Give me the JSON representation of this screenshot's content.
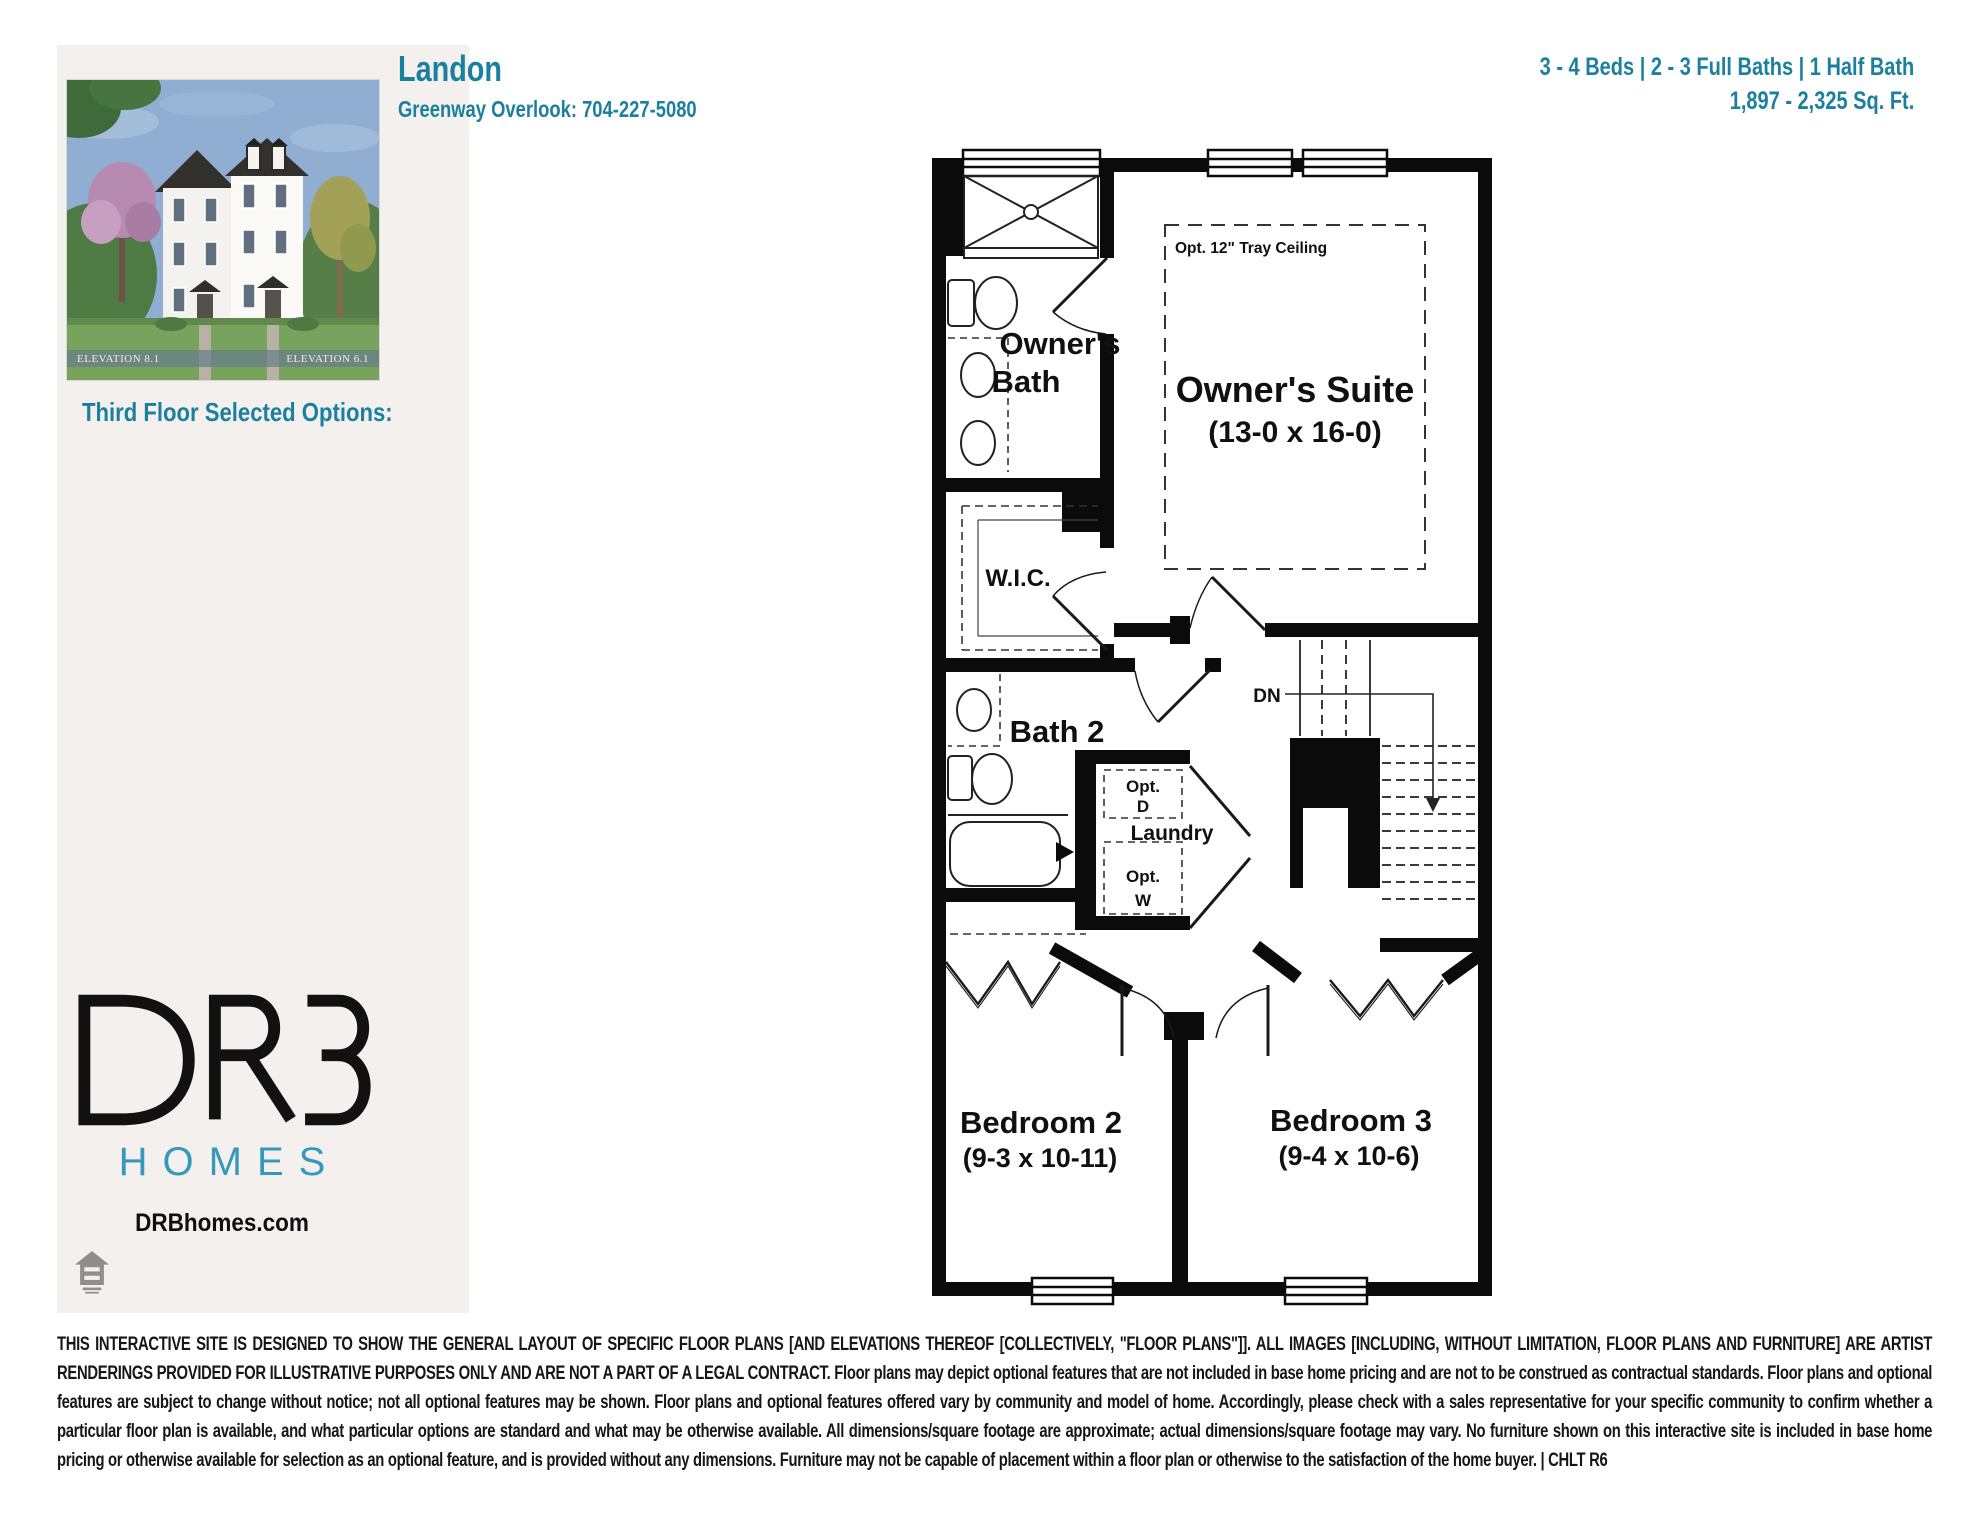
{
  "colors": {
    "teal": "#1b7f9f",
    "homes_blue": "#3598bd",
    "panel_bg": "#f3f0ee",
    "wall_black": "#0b0b0b"
  },
  "header": {
    "plan_name": "Landon",
    "community_phone": "Greenway Overlook: 704-227-5080",
    "specs_line1": "3 - 4 Beds | 2 - 3 Full Baths | 1 Half Bath",
    "specs_line2": "1,897 - 2,325 Sq. Ft."
  },
  "sidebar": {
    "elevation_left_label": "ELEVATION 8.1",
    "elevation_right_label": "ELEVATION 6.1",
    "selected_options_heading": "Third Floor Selected Options:",
    "logo": {
      "name": "DRB",
      "homes": "HOMES",
      "website": "DRBhomes.com"
    }
  },
  "floor_plan": {
    "rooms": {
      "owners_bath_line1": "Owner's",
      "owners_bath_line2": "Bath",
      "owners_suite_name": "Owner's Suite",
      "owners_suite_dims": "(13-0 x 16-0)",
      "tray_option": "Opt. 12\" Tray Ceiling",
      "wic": "W.I.C.",
      "bath2": "Bath 2",
      "dn": "DN",
      "opt_d_1": "Opt.",
      "opt_d_2": "D",
      "laundry": "Laundry",
      "opt_w_1": "Opt.",
      "opt_w_2": "W",
      "bedroom2_name": "Bedroom 2",
      "bedroom2_dims": "(9-3 x 10-11)",
      "bedroom3_name": "Bedroom 3",
      "bedroom3_dims": "(9-4 x 10-6)"
    }
  },
  "disclaimer": {
    "text": "THIS INTERACTIVE SITE IS DESIGNED TO SHOW THE GENERAL LAYOUT OF SPECIFIC FLOOR PLANS [AND ELEVATIONS THEREOF [COLLECTIVELY, \"FLOOR PLANS\"]]. ALL IMAGES [INCLUDING, WITHOUT LIMITATION, FLOOR PLANS AND FURNITURE] ARE ARTIST RENDERINGS PROVIDED FOR ILLUSTRATIVE PURPOSES ONLY AND ARE NOT A PART OF A LEGAL CONTRACT. Floor plans may depict optional features that are not included in base home pricing and are not to be construed as contractual standards. Floor plans and optional features are subject to change without notice; not all optional features may be shown. Floor plans and optional features offered vary by community and model of home. Accordingly, please check with a sales representative for your specific community to confirm whether a particular floor plan is available, and what particular options are standard and what may be otherwise available. All dimensions/square footage are approximate; actual dimensions/square footage may vary. No furniture shown on this interactive site is included in base home pricing or otherwise available for selection as an optional feature, and is provided without any dimensions. Furniture may not be capable of placement within a floor plan or otherwise to the satisfaction of the home buyer. | CHLT R6"
  }
}
